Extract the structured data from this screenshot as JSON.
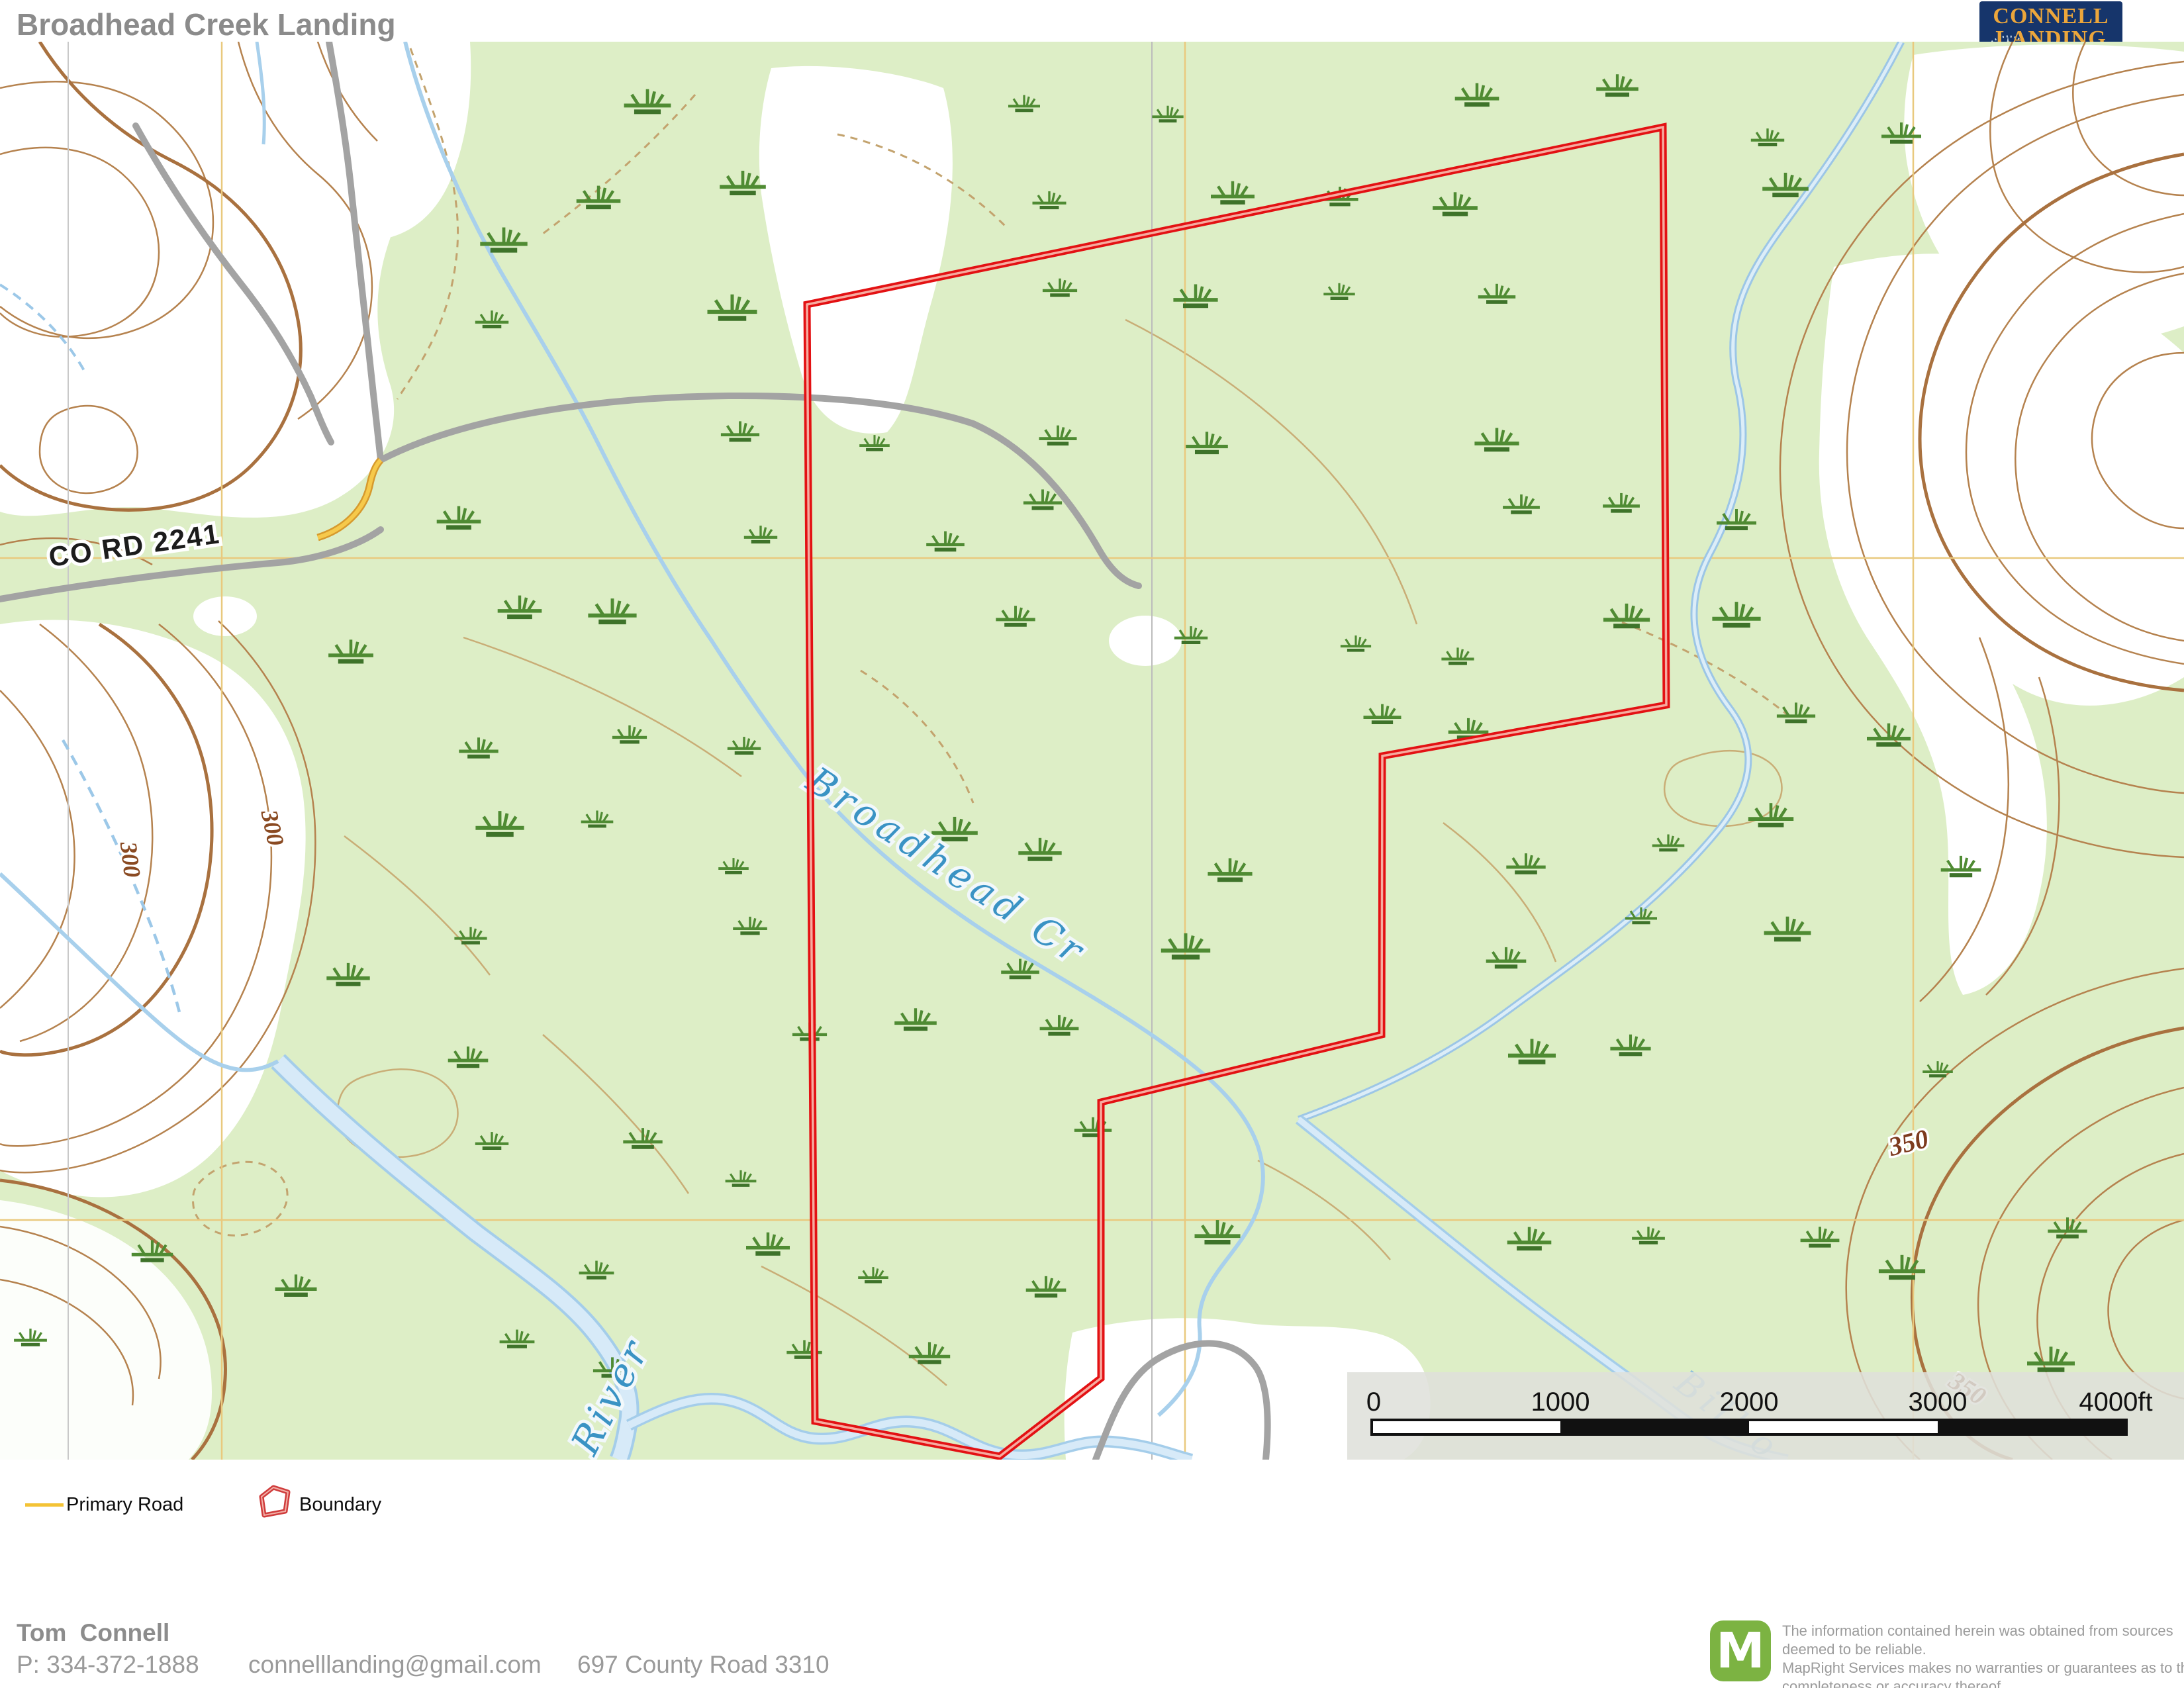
{
  "header": {
    "title": "Broadhead Creek Landing",
    "subtitle": "Pike County, Alabama, 353 AC +/-"
  },
  "logo": {
    "line1": "CONNELL",
    "line2": "LANDING",
    "line3": "REALTY",
    "suffix": "LLC",
    "phone": "334-372-1888"
  },
  "map": {
    "labels": {
      "road": "CO RD 2241",
      "creek": "Broadhead Cr",
      "river": "River",
      "river2": "Bilbo",
      "contour300a": "300",
      "contour300b": "300",
      "contour350a": "350",
      "contour350b": "350"
    },
    "scalebar": {
      "t0": "0",
      "t1": "1000",
      "t2": "2000",
      "t3": "3000",
      "t4": "4000ft"
    }
  },
  "legend": {
    "primary_road": "Primary Road",
    "boundary": "Boundary"
  },
  "footer": {
    "agent": "Tom Connell",
    "phone": "P: 334-372-1888",
    "email": "connelllanding@gmail.com",
    "address": "697 County Road 3310"
  },
  "disclaimer": {
    "logo_letter": "M",
    "line1": "The information contained herein was obtained from sources",
    "line2": "deemed to be reliable.",
    "line3": " MapRight Services makes no warranties or guarantees as to the",
    "line4": "completeness or accuracy thereof."
  },
  "colors": {
    "map_green": "#ddeec6",
    "contour_brown": "#b5824e",
    "contour_index": "#a9713f",
    "water_blue": "#a8d0ec",
    "water_fill": "#d7eaf8",
    "road_gray": "#a3a3a3",
    "primary_road_yellow": "#f4c335",
    "boundary_red": "#e31113",
    "brand_navy": "#16356b",
    "brand_gold": "#eca63b",
    "mapright_green": "#7cb342",
    "label_blue": "#3a93c4"
  }
}
